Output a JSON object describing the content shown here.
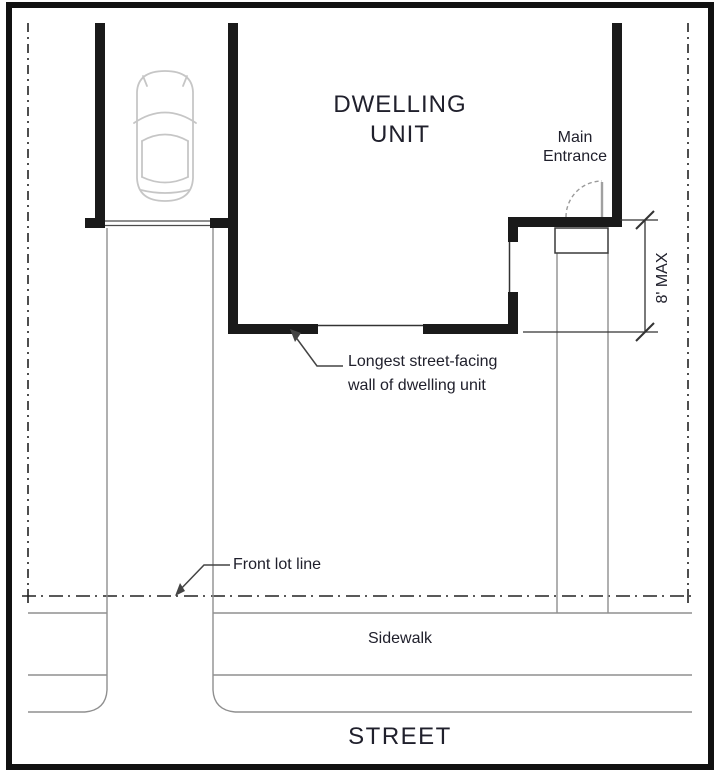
{
  "diagram": {
    "title_lines": [
      "DWELLING",
      "UNIT"
    ],
    "labels": {
      "main_entrance_lines": [
        "Main",
        "Entrance"
      ],
      "dimension": "8' MAX",
      "longest_wall_lines": [
        "Longest street-facing",
        "wall of dwelling unit"
      ],
      "front_lot_line": "Front lot line",
      "sidewalk": "Sidewalk",
      "street": "STREET"
    },
    "colors": {
      "wall": "#1a1a1a",
      "frame_border": "#111111",
      "lot_line": "#222222",
      "site_line": "#8f8f8f",
      "dimension_line": "#333333",
      "leader_line": "#444444",
      "door": "#a0a0a0",
      "car_outline": "#c6c6c6",
      "text": "#20202c",
      "background": "#ffffff"
    }
  }
}
